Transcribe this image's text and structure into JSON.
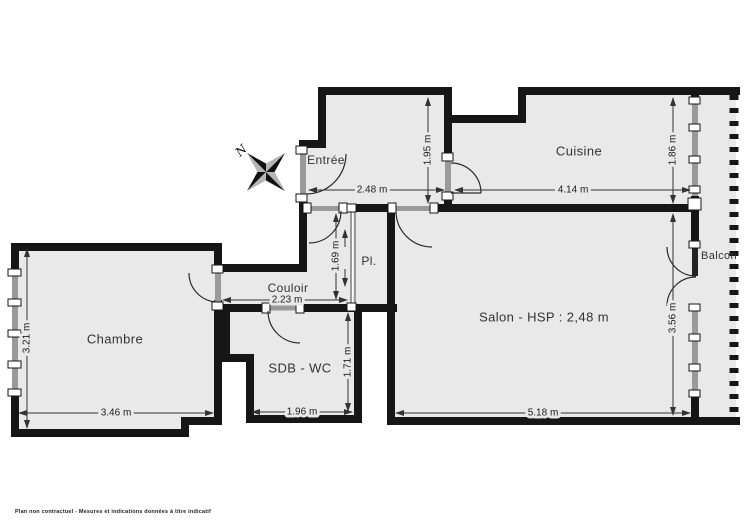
{
  "rooms": {
    "entree": {
      "label": "Entrée"
    },
    "cuisine": {
      "label": "Cuisine"
    },
    "couloir": {
      "label": "Couloir"
    },
    "placard": {
      "label": "Pl."
    },
    "chambre": {
      "label": "Chambre"
    },
    "sdb": {
      "label": "SDB - WC"
    },
    "salon": {
      "label": "Salon - HSP : 2,48 m"
    },
    "balcon": {
      "label": "Balcon"
    }
  },
  "dimensions": {
    "entree_width": "2.48 m",
    "entree_depth": "1.95 m",
    "cuisine_width": "4.14 m",
    "cuisine_depth": "1.86 m",
    "couloir_width": "2.23 m",
    "couloir_depth": "1.69 m",
    "chambre_depth": "3.21 m",
    "chambre_width": "3.46 m",
    "sdb_width": "1.96 m",
    "sdb_depth": "1.71 m",
    "salon_width": "5.18 m",
    "salon_depth": "3.56 m"
  },
  "compass": {
    "north": "N"
  },
  "footer": {
    "disclaimer": "Plan non contractuel - Mesures et indications données à titre indicatif"
  },
  "colors": {
    "floor": "#e9e9e9",
    "wall": "#161616",
    "frame": "#9a9a9a",
    "dimension": "#333333",
    "text": "#333333",
    "compass_light": "#b5b5b5",
    "compass_dark": "#111111"
  }
}
